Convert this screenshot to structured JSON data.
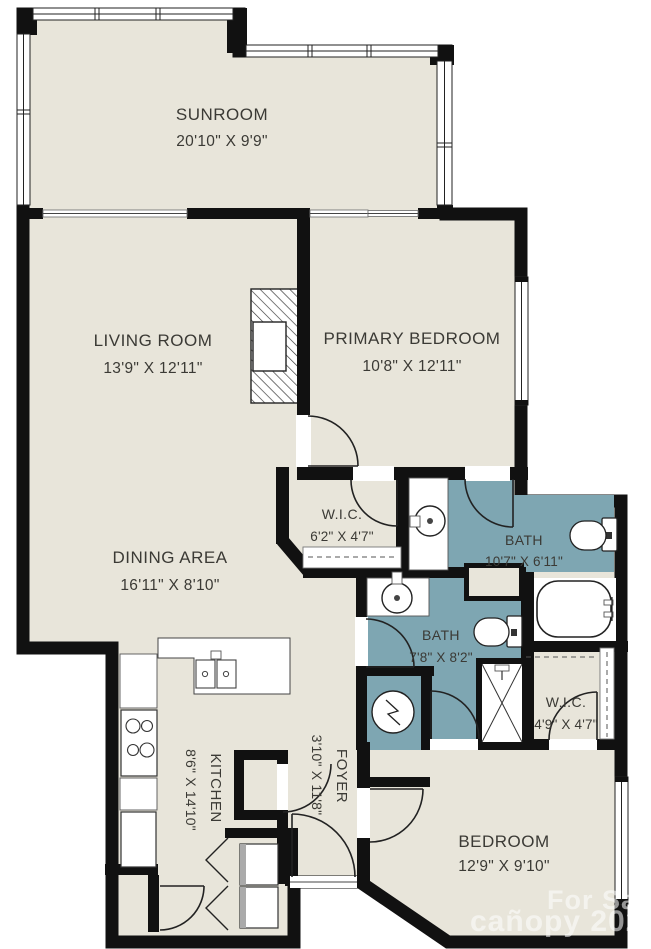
{
  "floorplan": {
    "rooms": {
      "sunroom": {
        "name": "SUNROOM",
        "dims": "20'10\" X 9'9\""
      },
      "living_room": {
        "name": "LIVING ROOM",
        "dims": "13'9\" X 12'11\""
      },
      "primary_bedroom": {
        "name": "PRIMARY BEDROOM",
        "dims": "10'8\" X 12'11\""
      },
      "dining_area": {
        "name": "DINING AREA",
        "dims": "16'11\" X 8'10\""
      },
      "wic_primary": {
        "name": "W.I.C.",
        "dims": "6'2\" X 4'7\""
      },
      "bath_primary": {
        "name": "BATH",
        "dims": "10'7\" X 6'11\""
      },
      "bath_hall": {
        "name": "BATH",
        "dims": "7'8\" X 8'2\""
      },
      "wic_bedroom": {
        "name": "W.I.C.",
        "dims": "4'9\" X 4'7\""
      },
      "bedroom": {
        "name": "BEDROOM",
        "dims": "12'9\" X 9'10\""
      },
      "kitchen": {
        "name": "KITCHEN",
        "dims": "8'6\" X 14'10\""
      },
      "foyer": {
        "name": "FOYER",
        "dims": "3'10\" X 11'8\""
      }
    },
    "watermark": {
      "line1": "For Sale",
      "line2": "cañopy 2025"
    },
    "colors": {
      "floor": "#e8e5da",
      "bath": "#7ea6b2",
      "wall": "#111111",
      "text": "#3b3a35",
      "background": "#ffffff"
    }
  }
}
